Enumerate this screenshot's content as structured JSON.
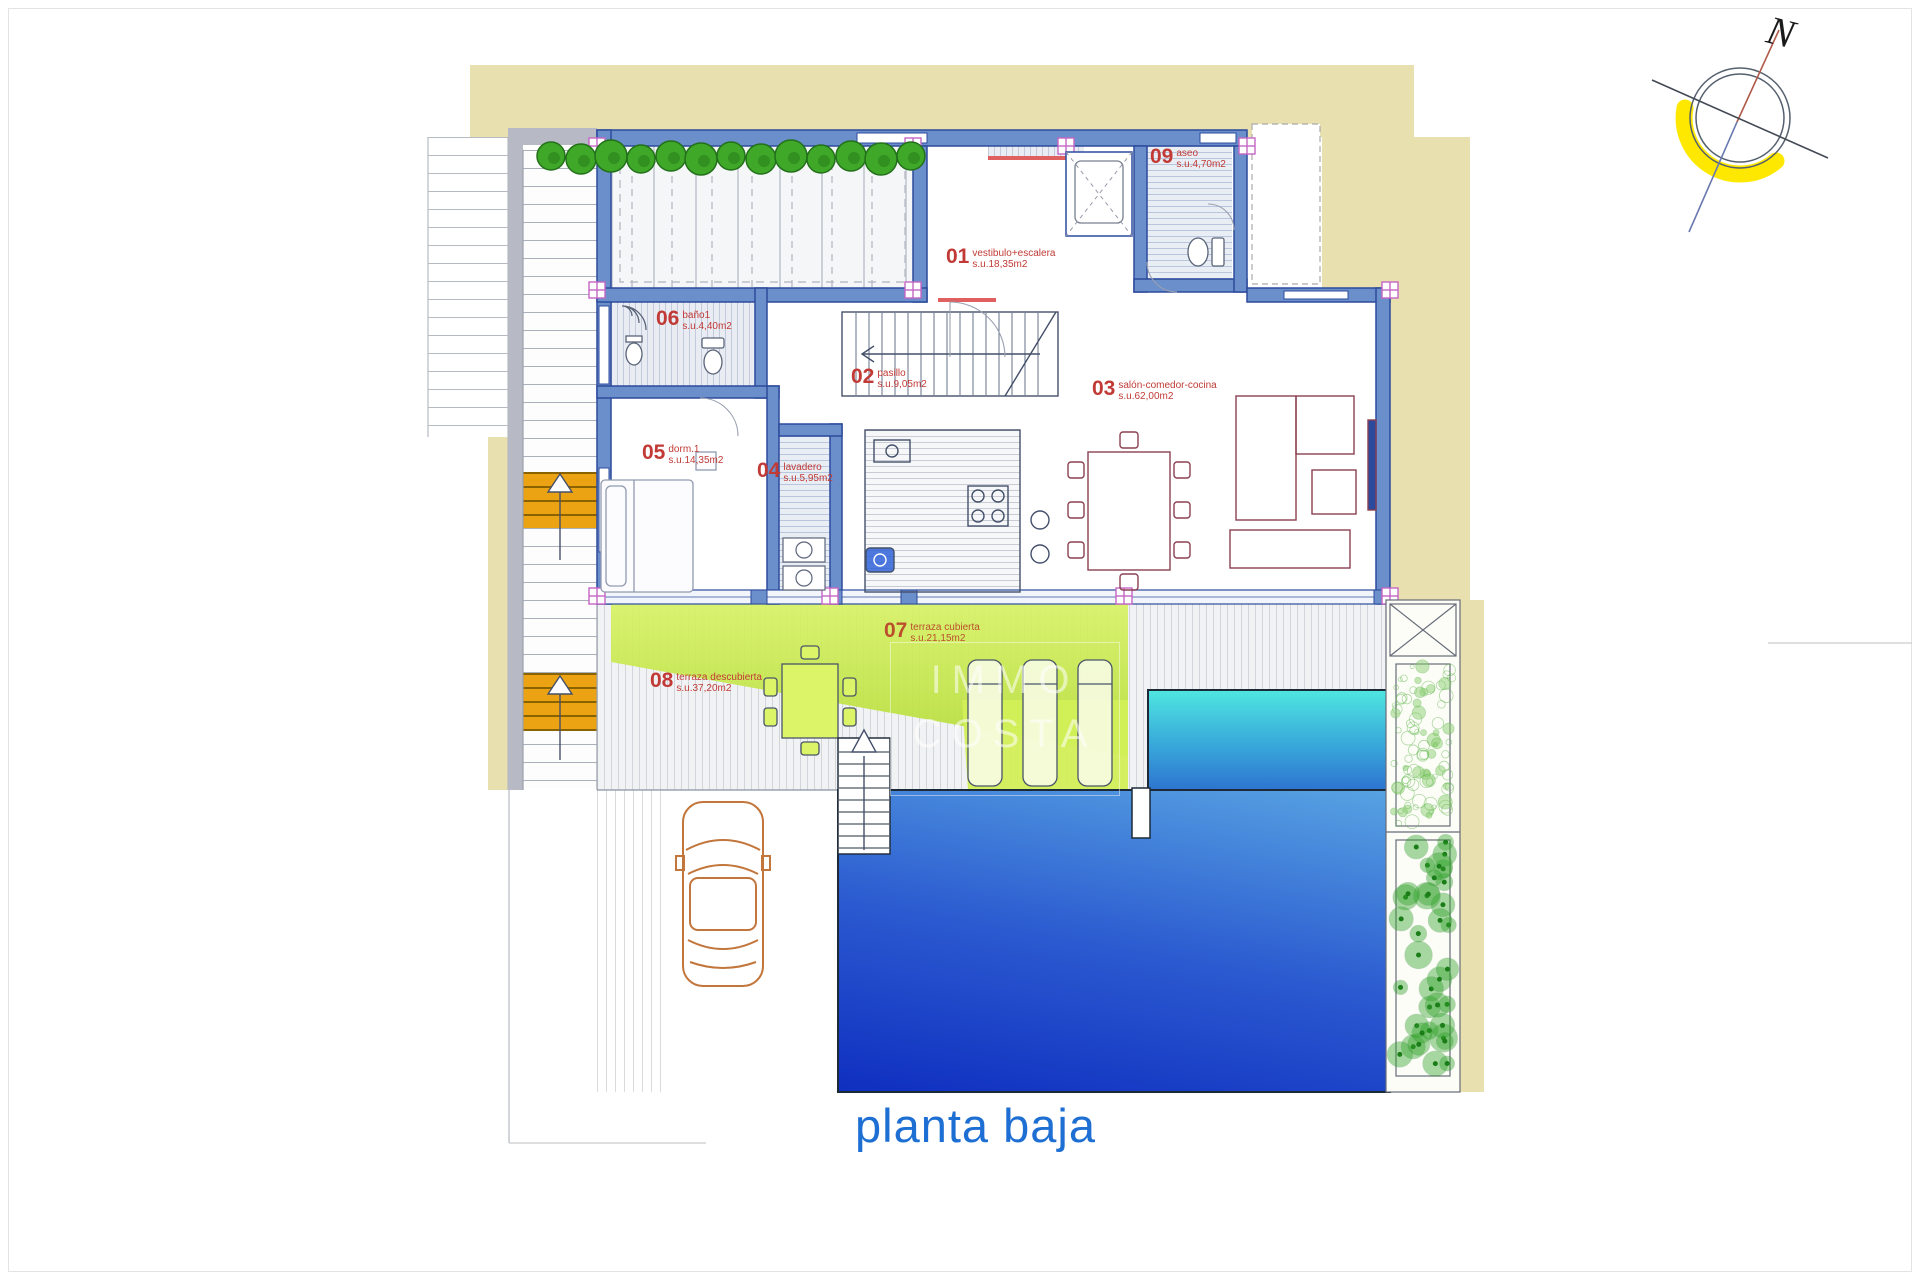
{
  "title": "planta baja",
  "compass": {
    "label": "N"
  },
  "watermark": {
    "line1": "IMMO",
    "line2": "COSTA"
  },
  "rooms": [
    {
      "number": "01",
      "name": "vestibulo+escalera",
      "area": "s.u.18,35m2"
    },
    {
      "number": "02",
      "name": "pasillo",
      "area": "s.u.9,05m2"
    },
    {
      "number": "03",
      "name": "salón-comedor-cocina",
      "area": "s.u.62,00m2"
    },
    {
      "number": "04",
      "name": "lavadero",
      "area": "s.u.5,95m2"
    },
    {
      "number": "05",
      "name": "dorm.1",
      "area": "s.u.14,35m2"
    },
    {
      "number": "06",
      "name": "baño1",
      "area": "s.u.4,40m2"
    },
    {
      "number": "07",
      "name": "terraza cubierta",
      "area": "s.u.21,15m2"
    },
    {
      "number": "08",
      "name": "terraza descubierta",
      "area": "s.u.37,20m2"
    },
    {
      "number": "09",
      "name": "aseo",
      "area": "s.u.4,70m2"
    }
  ],
  "colors": {
    "site_beige": "#e9e0b0",
    "wall_blue": "#6b8fcb",
    "wall_edge": "#2c4b9d",
    "pool_deep": "#0f2fc0",
    "pool_light": "#57a3e2",
    "pool_cyan": "#4fe6e0",
    "terrace_green": "#c9e84e",
    "stair_orange": "#eba313",
    "tree_green": "#3fa829",
    "label_red": "#c13a35",
    "title_blue": "#1e6fd3",
    "compass_yellow": "#ffe800"
  }
}
